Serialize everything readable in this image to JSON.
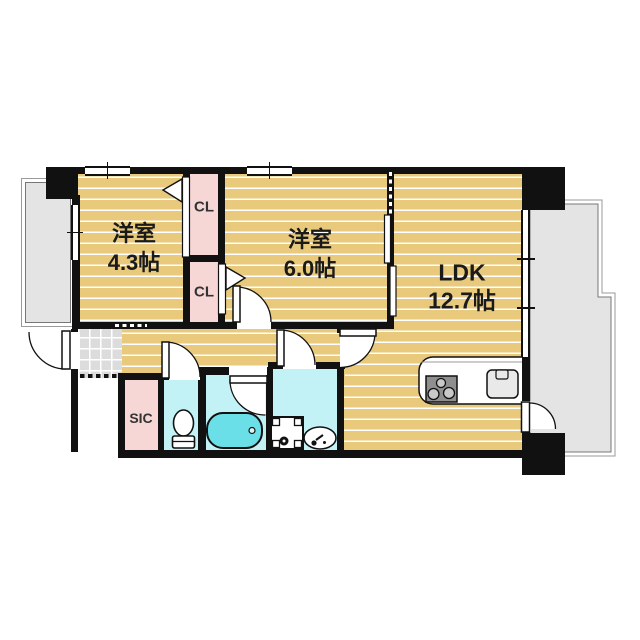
{
  "floorplan": {
    "type": "apartment-floor-plan",
    "rooms": {
      "bedroom_west": {
        "name": "洋室",
        "size": "4.3帖"
      },
      "bedroom_center": {
        "name": "洋室",
        "size": "6.0帖"
      },
      "ldk": {
        "name": "LDK",
        "size": "12.7帖"
      },
      "closet_upper": {
        "label": "CL"
      },
      "closet_lower": {
        "label": "CL"
      },
      "shoes_in_closet": {
        "label": "SIC"
      }
    },
    "fixtures": [
      "bathtub",
      "toilet",
      "washing-machine-pan",
      "vanity-sink",
      "kitchen-counter",
      "gas-stove",
      "kitchen-sink",
      "entrance-door",
      "balcony-door",
      "sliding-partition",
      "genkan-tile-floor"
    ],
    "colors": {
      "wall": "#111111",
      "wood_floor": "#e9c97c",
      "wet_area": "#c2f2f6",
      "closet": "#f7d6d6",
      "bathtub": "#6adfe8",
      "balcony": "#e4e4e4",
      "tile": "#dcdcdc"
    }
  }
}
